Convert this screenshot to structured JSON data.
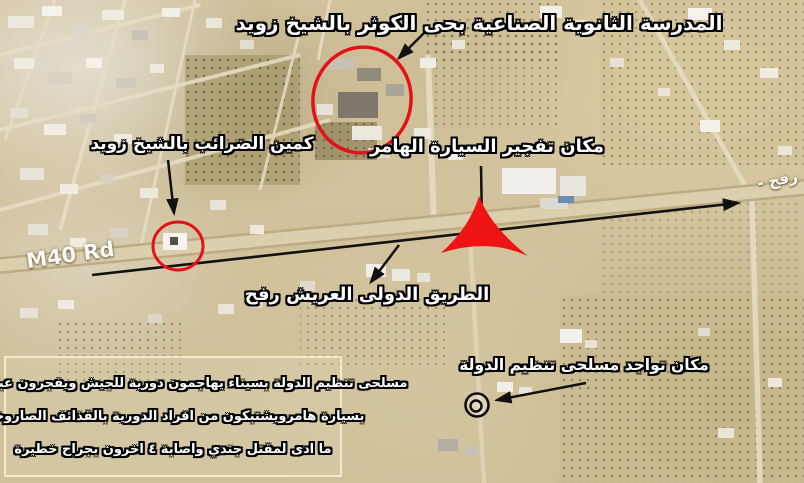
{
  "map": {
    "road_name": "M40 Rd",
    "road_destination": "- رفح"
  },
  "annotations": {
    "school_label": "المدرسة الثانوية الصناعية بحى الكوثر بالشيخ زويد",
    "tax_ambush_label": "كمين الضرائب بالشيخ زويد",
    "hummer_explosion_label": "مكان تفجير السيارة الهامر",
    "international_road_label": "الطريق الدولى العريش رفح",
    "militants_location_label": "مكان تواجد مسلحى تنظيم الدولة"
  },
  "info_box": {
    "line1": "مسلحى تنظيم الدولة بسيناء يهاجمون دورية للجيش ويفجرون عبوة ناسفة",
    "line2": "بسيارة هامرويشتبكون من افراد الدورية بالقذائف الصاروخية",
    "line3": "ما ادى لمقتل جندي واصابة ٤ اخرون بجراح خطيرة"
  },
  "colors": {
    "annotation_red": "#e8121b",
    "annotation_black": "#111111",
    "label_text": "#ffffff",
    "label_outline": "#000000",
    "map_label_text": "#fbfaf5",
    "info_box_border": "#f1ead2",
    "road_fill": "#dbcfae",
    "terrain_base": "#d0c09c"
  },
  "markers": {
    "explosion_star": "red-3-point-star",
    "school_circle": "red-ellipse",
    "tax_ambush_circle": "red-circle",
    "militants_spot": "black-double-circle"
  }
}
